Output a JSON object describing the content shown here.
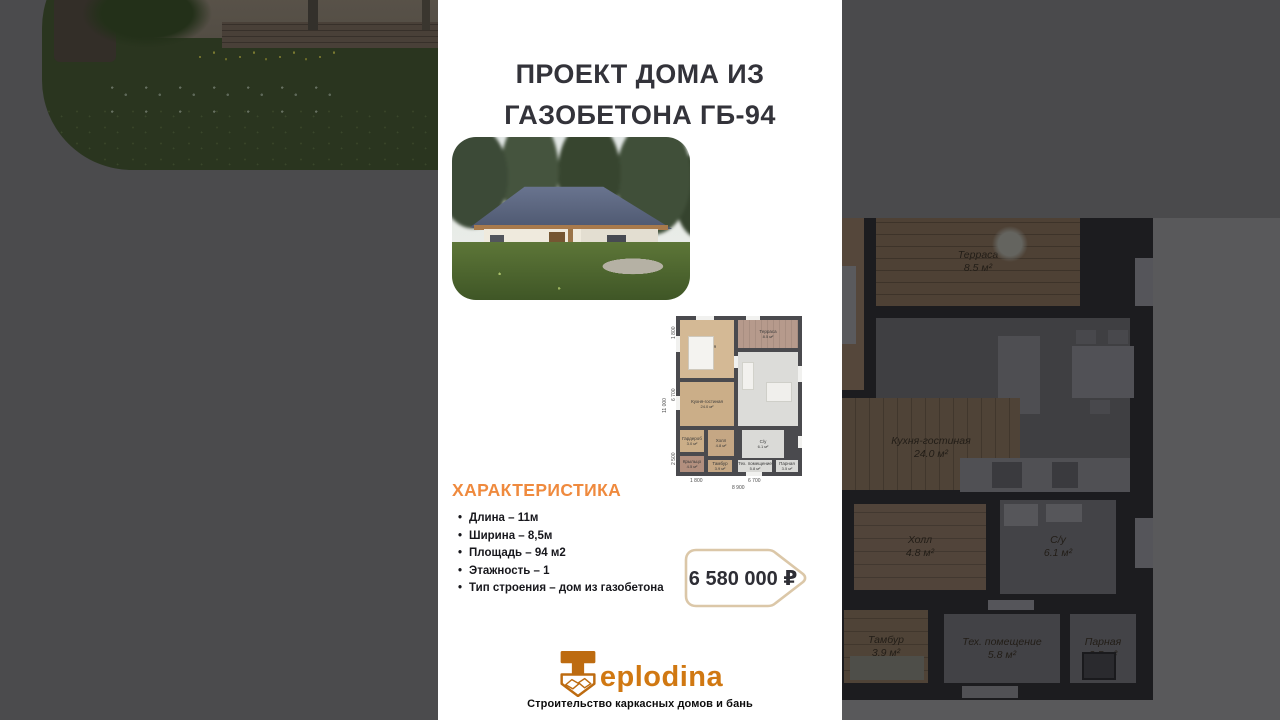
{
  "colors": {
    "accent_orange": "#ef8a3e",
    "logo_orange": "#d07812",
    "title_dark": "#33333a",
    "price_border": "#dbc7a8",
    "side_bg": "#4b4b4d"
  },
  "title": {
    "line1": "ПРОЕКТ ДОМА ИЗ",
    "line2": "ГАЗОБЕТОНА ГБ-94"
  },
  "characteristics": {
    "heading": "ХАРАКТЕРИСТИКА",
    "items": [
      "Длина – 11м",
      "Ширина – 8,5м",
      "Площадь – 94 м2",
      "Этажность – 1",
      "Тип строения – дом из газобетона"
    ]
  },
  "price": {
    "value": "6 580 000 ₽"
  },
  "logo": {
    "brand": "Teplodina",
    "brand_rest": "eplodina",
    "tagline": "Строительство каркасных домов и бань"
  },
  "floorplan": {
    "rooms": [
      {
        "name": "Спальня",
        "area": "11.7 м²"
      },
      {
        "name": "Терраса",
        "area": "8.5 м²"
      },
      {
        "name": "Кухня-гостиная",
        "area": "24.0 м²"
      },
      {
        "name": "Гардероб",
        "area": "3.0 м²"
      },
      {
        "name": "Холл",
        "area": "4.8 м²"
      },
      {
        "name": "С/у",
        "area": "6.1 м²"
      },
      {
        "name": "Крыльцо",
        "area": "4.5 м²"
      },
      {
        "name": "Тамбур",
        "area": "3.9 м²"
      },
      {
        "name": "Тех. помещение",
        "area": "5.8 м²"
      },
      {
        "name": "Парная",
        "area": "3.5 м²"
      }
    ],
    "dims_left": [
      "1 800",
      "6 700",
      "2 500"
    ],
    "dim_left_total": "11 000",
    "dims_bottom": [
      "1 800",
      "6 700"
    ],
    "dim_bottom_total": "8 900"
  },
  "backdrop_plan": {
    "rooms": [
      {
        "name": "Терраса",
        "area": "8.5 м²"
      },
      {
        "name": "Кухня-гостиная",
        "area": "24.0 м²"
      },
      {
        "name": "Холл",
        "area": "4.8 м²"
      },
      {
        "name": "С/у",
        "area": "6.1 м²"
      },
      {
        "name": "Тамбур",
        "area": "3.9 м²"
      },
      {
        "name": "Тех. помещение",
        "area": "5.8 м²"
      },
      {
        "name": "Парная",
        "area": "3.5 м²"
      }
    ]
  }
}
